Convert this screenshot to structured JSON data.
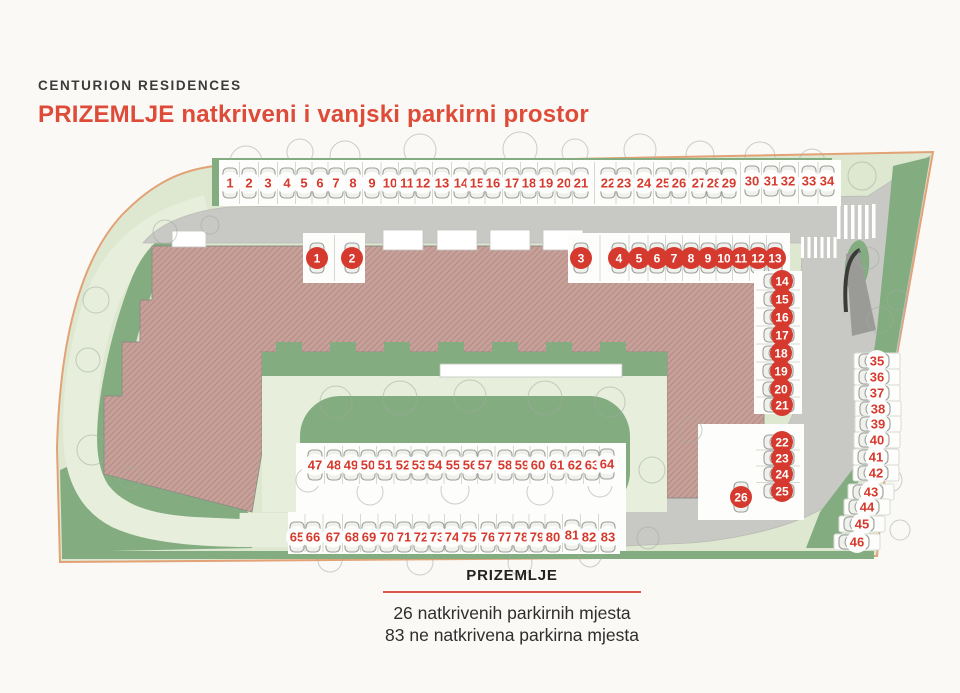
{
  "header": {
    "brand": "CENTURION RESIDENCES",
    "title": "PRIZEMLJE natkriveni i vanjski parkirni prostor"
  },
  "legend": {
    "title": "PRIZEMLJE",
    "covered_text": "26 natkrivenih parkirnih mjesta",
    "outdoor_text": "83 ne natkrivena parkirna mjesta"
  },
  "counts": {
    "covered": 26,
    "outdoor": 83
  },
  "colors": {
    "accent": "#D63A2E",
    "title_red": "#DE4B38",
    "rule_red": "#D9584C",
    "lawn": "#83AC80",
    "pale": "#DEE8D0",
    "path": "#E7EFDC",
    "road": "#C8C9C5",
    "building": "#C7A199",
    "boundary": "#E2A276"
  },
  "parking": {
    "groups": [
      {
        "id": "outdoor-top-row",
        "type": "outdoor",
        "car": "up",
        "band": [
          219,
          160,
          622,
          46
        ],
        "spots": [
          {
            "n": 1,
            "x": 230,
            "y": 183
          },
          {
            "n": 2,
            "x": 249,
            "y": 183
          },
          {
            "n": 3,
            "x": 268,
            "y": 183
          },
          {
            "n": 4,
            "x": 287,
            "y": 183
          },
          {
            "n": 5,
            "x": 304,
            "y": 183
          },
          {
            "n": 6,
            "x": 320,
            "y": 183
          },
          {
            "n": 7,
            "x": 336,
            "y": 183
          },
          {
            "n": 8,
            "x": 353,
            "y": 183
          },
          {
            "n": 9,
            "x": 372,
            "y": 183
          },
          {
            "n": 10,
            "x": 390,
            "y": 183
          },
          {
            "n": 11,
            "x": 407,
            "y": 183
          },
          {
            "n": 12,
            "x": 423,
            "y": 183
          },
          {
            "n": 13,
            "x": 442,
            "y": 183
          },
          {
            "n": 14,
            "x": 461,
            "y": 183
          },
          {
            "n": 15,
            "x": 477,
            "y": 183
          },
          {
            "n": 16,
            "x": 493,
            "y": 183
          },
          {
            "n": 17,
            "x": 512,
            "y": 183
          },
          {
            "n": 18,
            "x": 529,
            "y": 183
          },
          {
            "n": 19,
            "x": 546,
            "y": 183
          },
          {
            "n": 20,
            "x": 564,
            "y": 183
          },
          {
            "n": 21,
            "x": 581,
            "y": 183
          },
          {
            "n": 22,
            "x": 608,
            "y": 183
          },
          {
            "n": 23,
            "x": 624,
            "y": 183
          },
          {
            "n": 24,
            "x": 644,
            "y": 183
          },
          {
            "n": 25,
            "x": 663,
            "y": 183
          },
          {
            "n": 26,
            "x": 679,
            "y": 183
          },
          {
            "n": 27,
            "x": 699,
            "y": 183
          },
          {
            "n": 28,
            "x": 714,
            "y": 183
          },
          {
            "n": 29,
            "x": 729,
            "y": 183
          },
          {
            "n": 30,
            "x": 752,
            "y": 181
          },
          {
            "n": 31,
            "x": 771,
            "y": 181
          },
          {
            "n": 32,
            "x": 788,
            "y": 181
          },
          {
            "n": 33,
            "x": 809,
            "y": 181
          },
          {
            "n": 34,
            "x": 827,
            "y": 181
          }
        ]
      },
      {
        "id": "covered-left",
        "type": "covered",
        "car": "up",
        "band": [
          303,
          233,
          62,
          50
        ],
        "spots": [
          {
            "n": 1,
            "x": 317,
            "y": 258
          },
          {
            "n": 2,
            "x": 352,
            "y": 258
          }
        ]
      },
      {
        "id": "covered-top",
        "type": "covered",
        "car": "up",
        "band": [
          568,
          233,
          222,
          50
        ],
        "spots": [
          {
            "n": 3,
            "x": 581,
            "y": 258
          },
          {
            "n": 4,
            "x": 619,
            "y": 258
          },
          {
            "n": 5,
            "x": 639,
            "y": 258
          },
          {
            "n": 6,
            "x": 657,
            "y": 258
          },
          {
            "n": 7,
            "x": 674,
            "y": 258
          },
          {
            "n": 8,
            "x": 691,
            "y": 258
          },
          {
            "n": 9,
            "x": 708,
            "y": 258
          },
          {
            "n": 10,
            "x": 724,
            "y": 258
          },
          {
            "n": 11,
            "x": 741,
            "y": 258
          },
          {
            "n": 12,
            "x": 758,
            "y": 258
          },
          {
            "n": 13,
            "x": 775,
            "y": 258
          }
        ]
      },
      {
        "id": "covered-col-upper",
        "type": "covered",
        "car": "left",
        "band": [
          754,
          271,
          48,
          143
        ],
        "spots": [
          {
            "n": 14,
            "x": 782,
            "y": 281
          },
          {
            "n": 15,
            "x": 782,
            "y": 299
          },
          {
            "n": 16,
            "x": 782,
            "y": 317
          },
          {
            "n": 17,
            "x": 782,
            "y": 335
          },
          {
            "n": 18,
            "x": 781,
            "y": 353
          },
          {
            "n": 19,
            "x": 781,
            "y": 371
          },
          {
            "n": 20,
            "x": 781,
            "y": 389
          },
          {
            "n": 21,
            "x": 782,
            "y": 405
          }
        ]
      },
      {
        "id": "covered-col-lower",
        "type": "covered",
        "car": "left",
        "band": [
          754,
          432,
          48,
          68
        ],
        "spots": [
          {
            "n": 22,
            "x": 782,
            "y": 442
          },
          {
            "n": 23,
            "x": 782,
            "y": 458
          },
          {
            "n": 24,
            "x": 782,
            "y": 474
          },
          {
            "n": 25,
            "x": 782,
            "y": 491
          }
        ]
      },
      {
        "id": "covered-single",
        "type": "covered",
        "car": "up",
        "band": [
          727,
          474,
          28,
          46
        ],
        "spots": [
          {
            "n": 26,
            "x": 741,
            "y": 497
          }
        ]
      },
      {
        "id": "outdoor-right-col",
        "type": "outdoor",
        "car": "left",
        "stall": [
          46,
          16
        ],
        "spots": [
          {
            "n": 35,
            "x": 877,
            "y": 361
          },
          {
            "n": 36,
            "x": 877,
            "y": 377
          },
          {
            "n": 37,
            "x": 877,
            "y": 393
          },
          {
            "n": 38,
            "x": 878,
            "y": 409
          },
          {
            "n": 39,
            "x": 878,
            "y": 424
          },
          {
            "n": 40,
            "x": 877,
            "y": 440
          },
          {
            "n": 41,
            "x": 876,
            "y": 457
          },
          {
            "n": 42,
            "x": 876,
            "y": 473
          },
          {
            "n": 43,
            "x": 871,
            "y": 492
          },
          {
            "n": 44,
            "x": 867,
            "y": 507
          },
          {
            "n": 45,
            "x": 862,
            "y": 524
          },
          {
            "n": 46,
            "x": 857,
            "y": 542
          }
        ]
      },
      {
        "id": "outdoor-mid-row",
        "type": "outdoor",
        "car": "up",
        "band": [
          302,
          444,
          318,
          42
        ],
        "spots": [
          {
            "n": 47,
            "x": 315,
            "y": 465
          },
          {
            "n": 48,
            "x": 334,
            "y": 465
          },
          {
            "n": 49,
            "x": 351,
            "y": 465
          },
          {
            "n": 50,
            "x": 368,
            "y": 465
          },
          {
            "n": 51,
            "x": 385,
            "y": 465
          },
          {
            "n": 52,
            "x": 403,
            "y": 465
          },
          {
            "n": 53,
            "x": 419,
            "y": 465
          },
          {
            "n": 54,
            "x": 435,
            "y": 465
          },
          {
            "n": 55,
            "x": 453,
            "y": 465
          },
          {
            "n": 56,
            "x": 470,
            "y": 465
          },
          {
            "n": 57,
            "x": 485,
            "y": 465
          },
          {
            "n": 58,
            "x": 505,
            "y": 465
          },
          {
            "n": 59,
            "x": 522,
            "y": 465
          },
          {
            "n": 60,
            "x": 538,
            "y": 465
          },
          {
            "n": 61,
            "x": 557,
            "y": 465
          },
          {
            "n": 62,
            "x": 575,
            "y": 465
          },
          {
            "n": 63,
            "x": 592,
            "y": 465
          },
          {
            "n": 64,
            "x": 607,
            "y": 464
          }
        ]
      },
      {
        "id": "outdoor-bottom-row",
        "type": "outdoor",
        "car": "up",
        "band": [
          288,
          512,
          332,
          42
        ],
        "spots": [
          {
            "n": 65,
            "x": 297,
            "y": 537
          },
          {
            "n": 66,
            "x": 313,
            "y": 537
          },
          {
            "n": 67,
            "x": 333,
            "y": 537
          },
          {
            "n": 68,
            "x": 352,
            "y": 537
          },
          {
            "n": 69,
            "x": 369,
            "y": 537
          },
          {
            "n": 70,
            "x": 387,
            "y": 537
          },
          {
            "n": 71,
            "x": 404,
            "y": 537
          },
          {
            "n": 72,
            "x": 421,
            "y": 537
          },
          {
            "n": 73,
            "x": 437,
            "y": 537
          },
          {
            "n": 74,
            "x": 452,
            "y": 537
          },
          {
            "n": 75,
            "x": 469,
            "y": 537
          },
          {
            "n": 76,
            "x": 488,
            "y": 537
          },
          {
            "n": 77,
            "x": 505,
            "y": 537
          },
          {
            "n": 78,
            "x": 521,
            "y": 537
          },
          {
            "n": 79,
            "x": 537,
            "y": 537
          },
          {
            "n": 80,
            "x": 553,
            "y": 537
          },
          {
            "n": 81,
            "x": 572,
            "y": 535
          },
          {
            "n": 82,
            "x": 589,
            "y": 537
          },
          {
            "n": 83,
            "x": 608,
            "y": 537
          }
        ]
      }
    ]
  }
}
